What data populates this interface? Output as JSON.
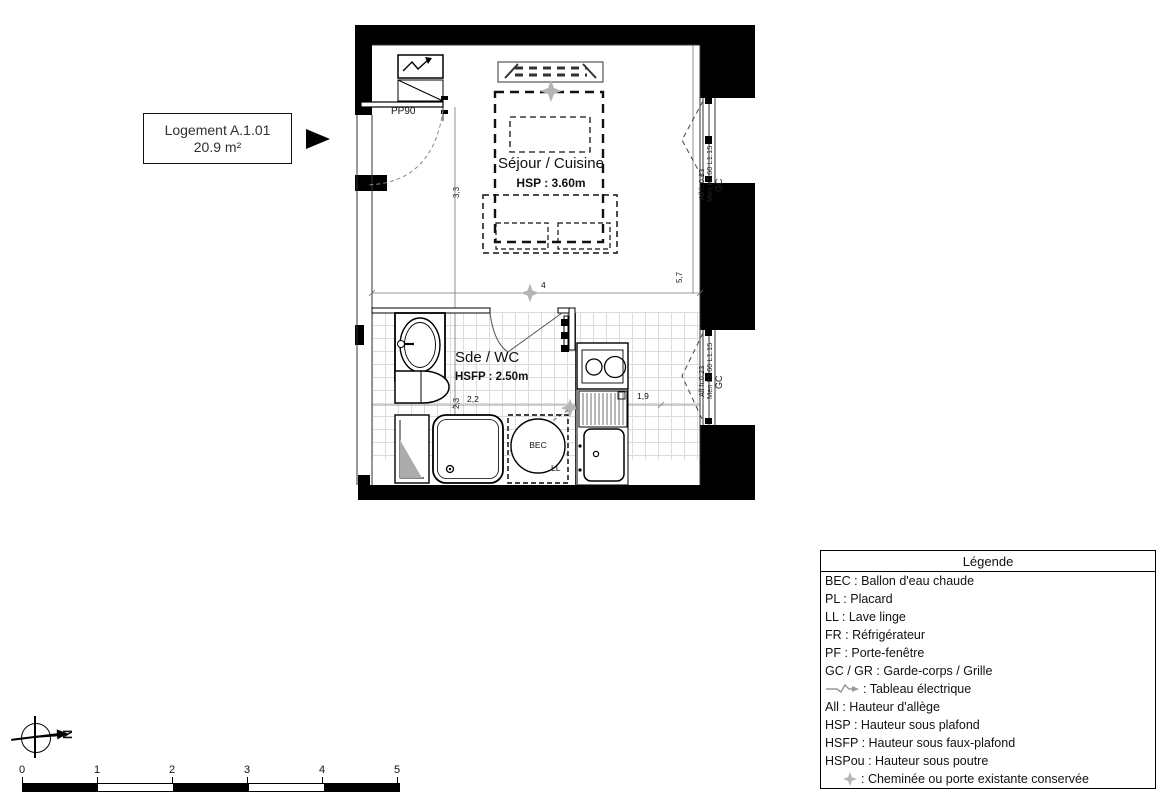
{
  "colors": {
    "ink": "#1a1a1a",
    "wall": "#000000",
    "star_gray": "#b5b5b5",
    "tile_line": "#dcdcdc",
    "electric_arrow_gray": "#999999"
  },
  "label_box": {
    "line1": "Logement A.1.01",
    "line2": "20.9 m²"
  },
  "plan": {
    "entrance_door_label": "PP90",
    "sejour": {
      "name": "Séjour / Cuisine",
      "ceiling": "HSP : 3.60m"
    },
    "sde": {
      "name": "Sde / WC",
      "ceiling": "HSFP : 2.50m"
    },
    "bec_label": "BEC",
    "ll_label": "LL",
    "dims": {
      "left": "3,3",
      "right": "5,7",
      "middle": "4",
      "bath_depth": "2,3",
      "bath_width": "2,2",
      "kitchen_width": "1,9"
    },
    "window_upper": {
      "allege": "All h:0.23",
      "menuiserie": "Men h2.60 L1.15",
      "gc": "GC"
    },
    "window_lower": {
      "allege": "All h:0.23",
      "menuiserie": "Men h2.60 L1.15",
      "gc": "GC"
    }
  },
  "legend": {
    "title": "Légende",
    "items": [
      {
        "icon": "none",
        "text": "BEC : Ballon d'eau chaude"
      },
      {
        "icon": "none",
        "text": "PL : Placard"
      },
      {
        "icon": "none",
        "text": "LL : Lave linge"
      },
      {
        "icon": "none",
        "text": "FR : Réfrigérateur"
      },
      {
        "icon": "none",
        "text": "PF : Porte-fenêtre"
      },
      {
        "icon": "none",
        "text": "GC / GR : Garde-corps / Grille"
      },
      {
        "icon": "electric-arrow",
        "text": ": Tableau électrique"
      },
      {
        "icon": "none",
        "text": "All : Hauteur d'allège"
      },
      {
        "icon": "none",
        "text": "HSP : Hauteur sous plafond"
      },
      {
        "icon": "none",
        "text": "HSFP : Hauteur sous faux-plafond"
      },
      {
        "icon": "none",
        "text": "HSPou : Hauteur sous poutre"
      },
      {
        "icon": "star",
        "text": ": Cheminée ou porte existante conservée"
      }
    ]
  },
  "compass": {
    "north_label": "N"
  },
  "scalebar": {
    "ticks": [
      "0",
      "1",
      "2",
      "3",
      "4",
      "5"
    ]
  }
}
